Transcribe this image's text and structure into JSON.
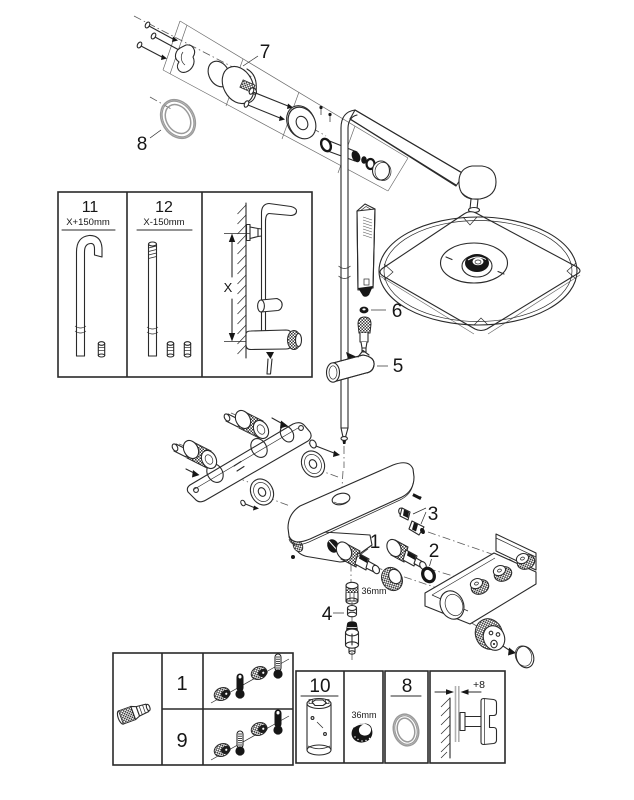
{
  "title": "shower-system-exploded-parts-diagram",
  "colors": {
    "line": "#2a2a2a",
    "gray_part": "#9a9a9a",
    "black_fill": "#161616",
    "background": "#ffffff"
  },
  "callouts": {
    "wall_mount_kit": "7",
    "seal_ring": "8",
    "hand_shower_seal": "6",
    "glide_holder": "5",
    "diverter_parts": "3",
    "cartridge_a": "1",
    "cartridge_b": "2",
    "wrench_size": "36mm",
    "check_valve": "4"
  },
  "pipe_length_box": {
    "option_long": {
      "number": "11",
      "length": "X+150mm"
    },
    "option_short": {
      "number": "12",
      "length": "X-150mm"
    },
    "dimension": "X"
  },
  "spares_box": {
    "cartridge_rows": [
      {
        "number": "1"
      },
      {
        "number": "9"
      }
    ],
    "mounting_tool": "10",
    "wrench_size": "36mm",
    "seal_ring": "8",
    "wall_offset": "+8"
  }
}
